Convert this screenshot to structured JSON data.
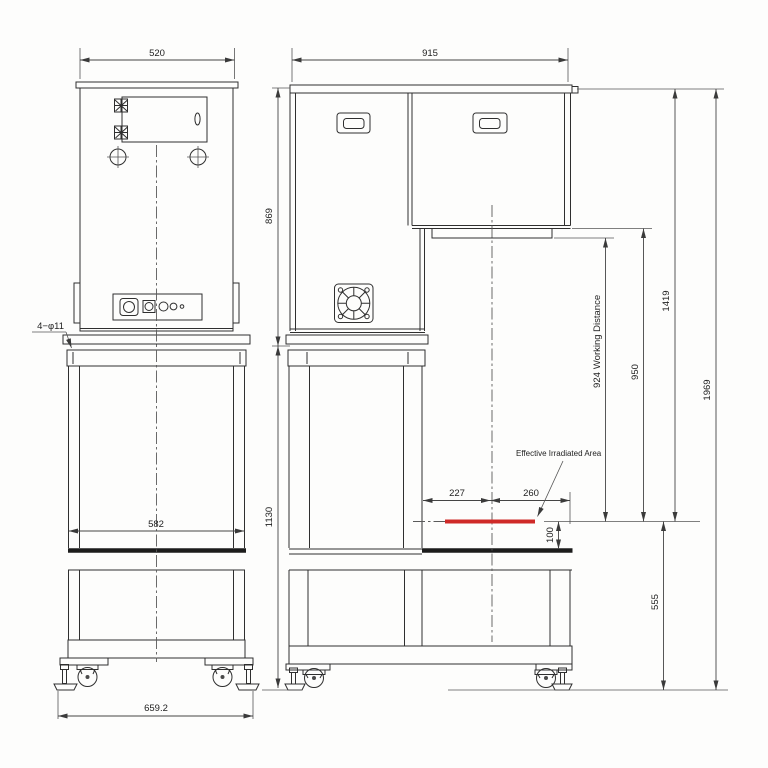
{
  "drawing": {
    "background": "#fdfdfc",
    "line_color": "#2f2f2f",
    "accent_color": "#cf2a28",
    "views": {
      "front": {
        "name": "front-elevation",
        "dims": {
          "top_width": "520",
          "stand_width": "582",
          "overall_base_width": "659.2",
          "mount_holes_label": "4−φ11"
        }
      },
      "side": {
        "name": "side-elevation",
        "dims": {
          "top_depth": "915",
          "upper_cabinet_height": "869",
          "stand_height": "1130",
          "table_front_offset": "227",
          "table_rear_offset": "260",
          "irradiation_height": "100",
          "working_distance_value": "924",
          "working_distance_label": "Working Distance",
          "lamp_housing_to_surface": "950",
          "head_top_to_surface": "1419",
          "surface_level_height": "555",
          "overall_height": "1969",
          "effective_area_label": "Effective Irradiated Area"
        }
      }
    }
  }
}
